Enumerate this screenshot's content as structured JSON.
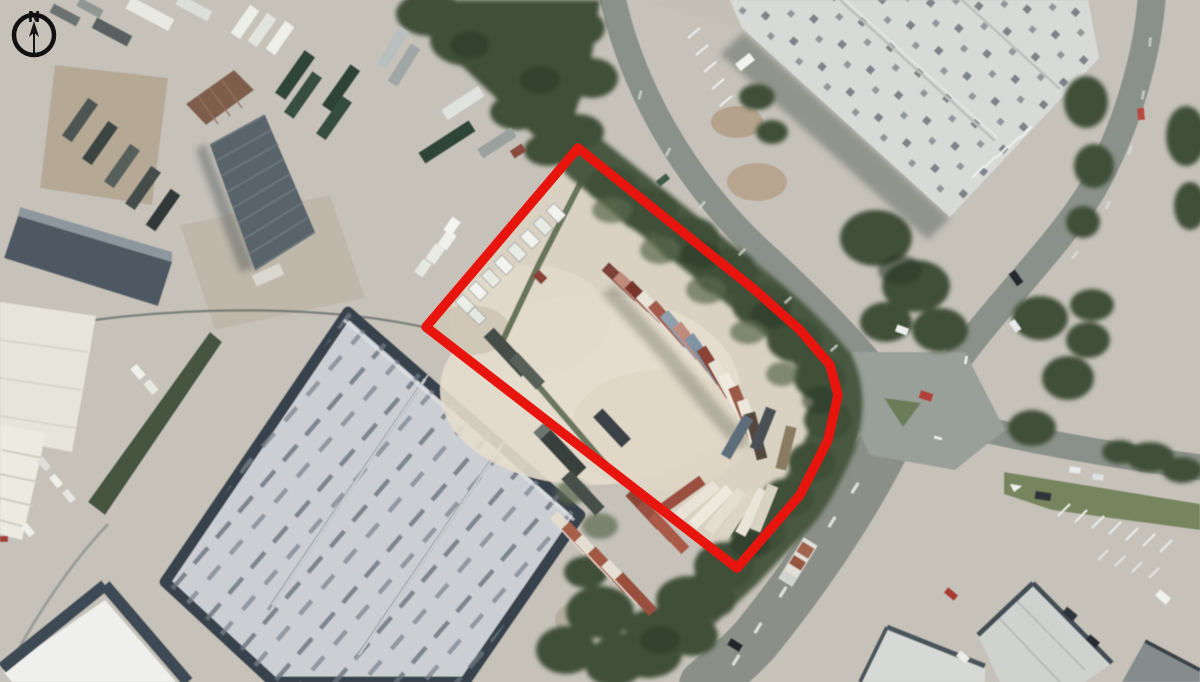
{
  "compass": {
    "label": "N"
  },
  "site_boundary": {
    "color": "#e8150f",
    "stroke_width": 9.5,
    "points": "578,148 755,290 800,330 830,365 838,395 828,440 800,495 737,568 426,327"
  },
  "palette": {
    "ground_concrete": "#c6c2ba",
    "site_dirt": "#d9d2c3",
    "tree_green": "#4a5841",
    "road_gray": "#8a918a",
    "warehouse_roof_gray": "#cbcfd3",
    "warehouse_roof_light": "#d8dad7",
    "roof_dark_band": "#39434d"
  }
}
